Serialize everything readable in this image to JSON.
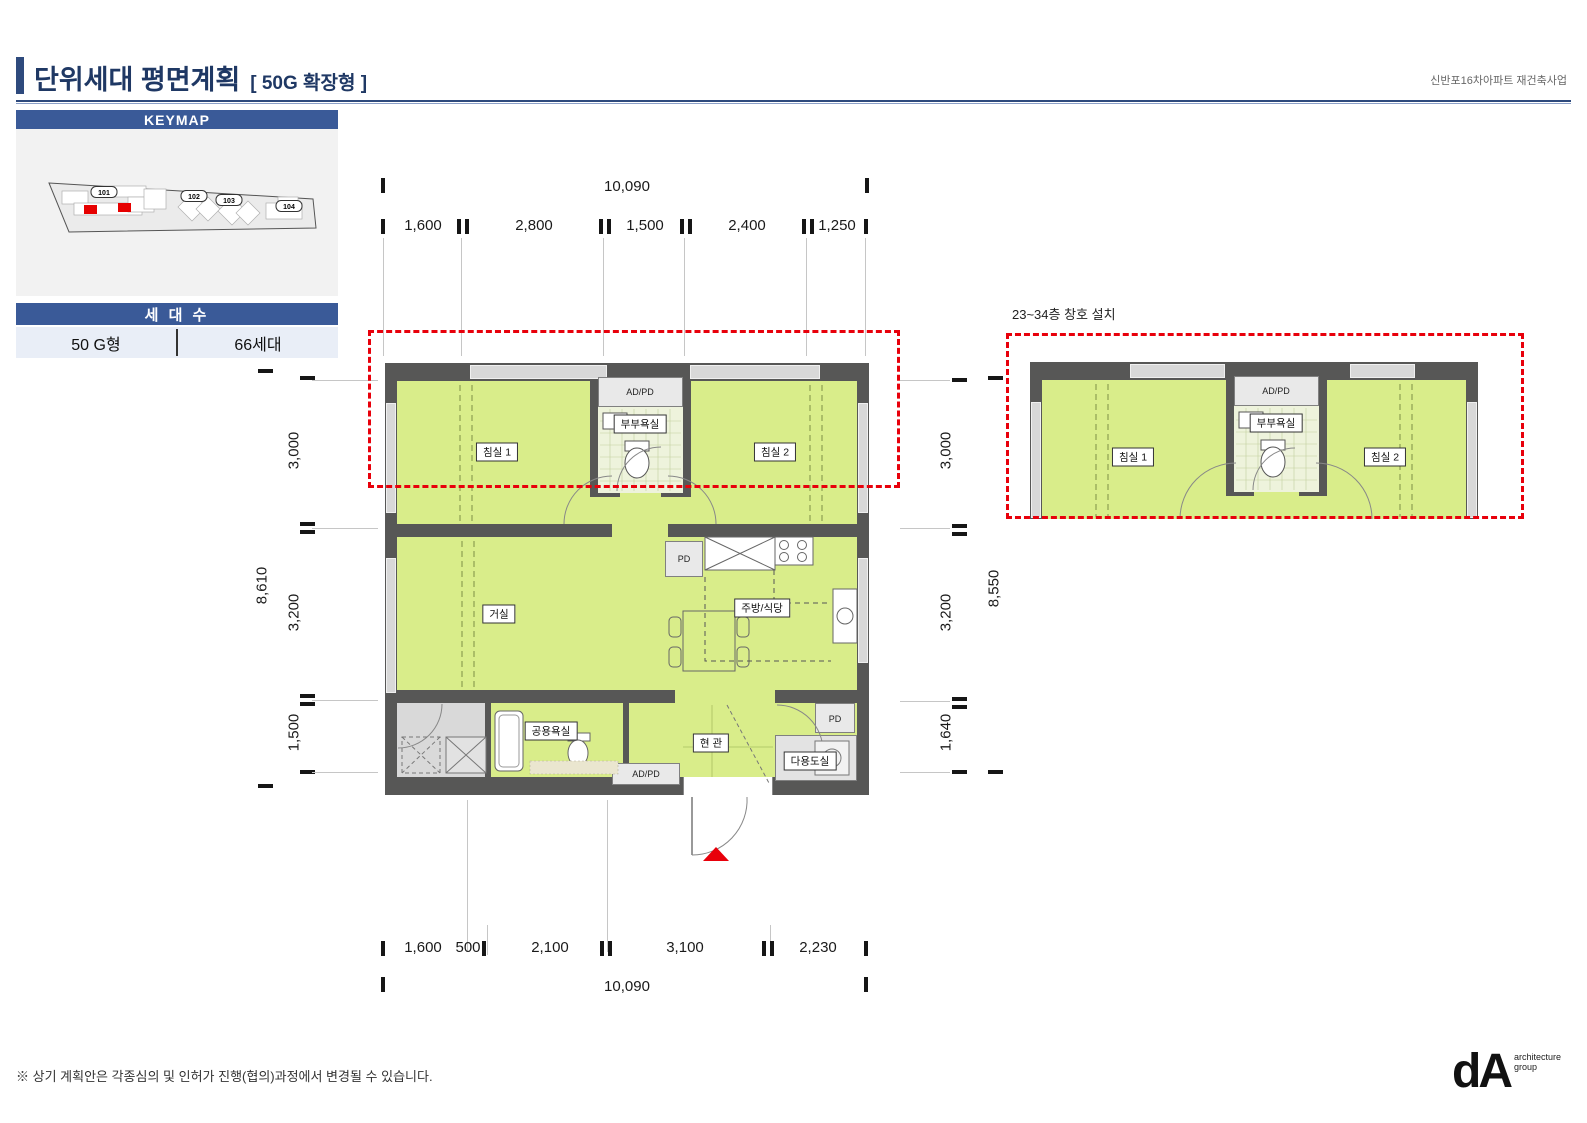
{
  "header": {
    "title": "단위세대 평면계획",
    "subtitle": "[ 50G 확장형 ]",
    "project": "신반포16차아파트 재건축사업"
  },
  "keymap": {
    "title": "KEYMAP",
    "buildings": [
      "101",
      "102",
      "103",
      "104"
    ]
  },
  "units": {
    "title": "세 대 수",
    "type": "50 G형",
    "count": "66세대"
  },
  "plan_labels": {
    "bedroom1": "침실 1",
    "bedroom2": "침실 2",
    "master_bath": "부부욕실",
    "adpd": "AD/PD",
    "living": "거실",
    "kitchen": "주방/식당",
    "pd": "PD",
    "common_bath": "공용욕실",
    "entry": "현 관",
    "utility": "다용도실"
  },
  "main_plan": {
    "dim_top_total": "10,090",
    "dim_top": [
      "1,600",
      "2,800",
      "1,500",
      "2,400",
      "1,250"
    ],
    "dim_left_total": "8,610",
    "dim_left": [
      "3,000",
      "3,200",
      "1,500"
    ],
    "dim_bottom": [
      "1,600",
      "500",
      "2,100",
      "3,100",
      "2,230"
    ],
    "dim_bottom_total": "10,090"
  },
  "right_plan": {
    "note": "23~34층 창호 설치",
    "dim_left_total": "8,550",
    "dim_left": [
      "3,000",
      "3,200",
      "1,640"
    ]
  },
  "footer": {
    "disclaimer": "※ 상기 계획안은 각종심의 및 인허가 진행(협의)과정에서 변경될 수 있습니다.",
    "logo": "dA",
    "logo_line1": "architecture",
    "logo_line2": "group"
  },
  "colors": {
    "navy": "#2e4a7d",
    "bar_blue": "#3a5a98",
    "unit_green": "#d9ed8a",
    "wall_gray": "#575756",
    "highlight_red": "#e8000b"
  }
}
